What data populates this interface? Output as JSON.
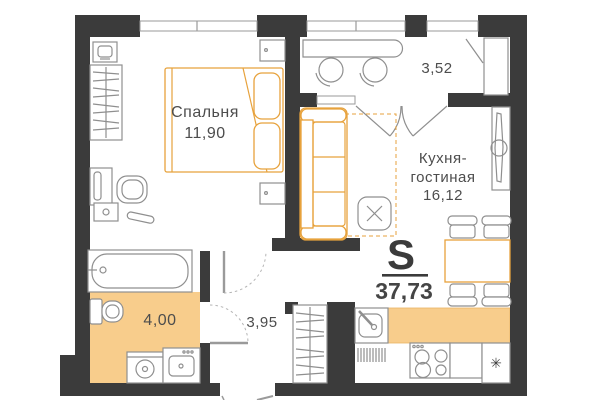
{
  "floorplan": {
    "rooms": {
      "bedroom": {
        "name": "Спальня",
        "area": "11,90"
      },
      "kitchen_living": {
        "name_line1": "Кухня-",
        "name_line2": "гостиная",
        "area": "16,12"
      },
      "balcony": {
        "area": "3,52"
      },
      "bathroom": {
        "area": "4,00"
      },
      "hallway": {
        "area": "3,95"
      },
      "total": {
        "label": "S",
        "area": "37,73"
      }
    },
    "icons": {
      "snowflake": "✳"
    },
    "colors": {
      "wall": "#3b3b3b",
      "accent_fill": "#f8cd8c",
      "accent_stroke": "#e7a23c",
      "furniture_stroke": "#8f8f8f",
      "text": "#4d4d4d"
    }
  }
}
